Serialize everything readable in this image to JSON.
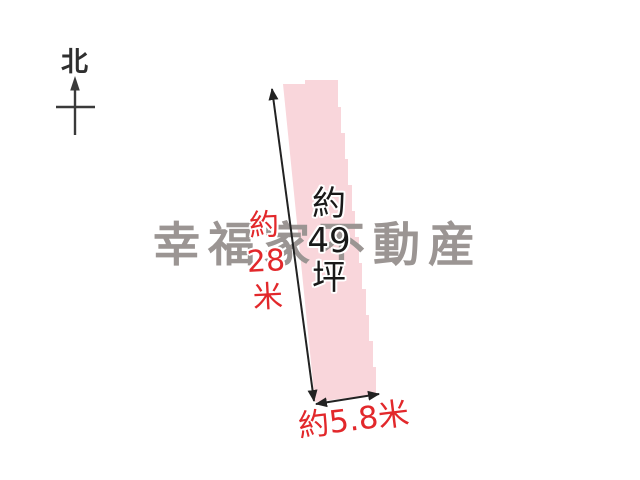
{
  "compass": {
    "label": "北",
    "icon": "north-arrow"
  },
  "watermark": {
    "text": "幸福家不動産",
    "color": "#9b9593"
  },
  "plot": {
    "fill_color": "#f9d6db",
    "outline_color": "#222222",
    "area_label_lines": [
      "約",
      "49",
      "坪"
    ],
    "area_label_text": "約49坪",
    "left_dimension_lines": [
      "約",
      "28",
      "米"
    ],
    "left_dimension_text": "約28米",
    "bottom_dimension_text": "約5.8米",
    "dimension_color": "#e2282b"
  }
}
